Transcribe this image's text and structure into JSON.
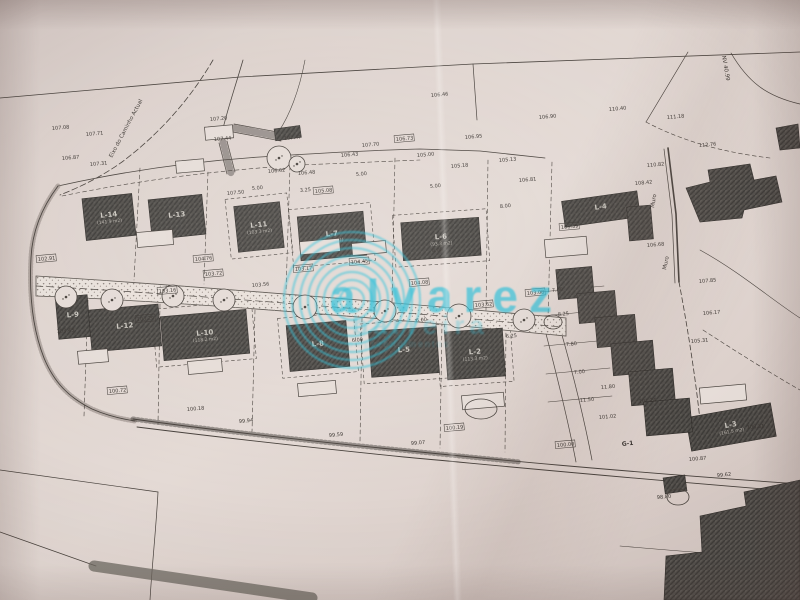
{
  "photo": {
    "paper_color": "#e0d5d0",
    "ink_color": "#46403b",
    "watermark_color": "#2bbdd6"
  },
  "watermark": {
    "line1": "alvarez",
    "line2": "barreira",
    "line3": "empreendimentos"
  },
  "plan": {
    "road_label": "Eixo do Caminho Actual",
    "nv_label": "NV 40.99",
    "muro1": "Muro",
    "muro2": "Muro",
    "g1_label": "G-1",
    "buildings": [
      {
        "label": "L-14",
        "area": "(141.9 m2)",
        "x": 84,
        "y": 196,
        "w": 50,
        "h": 42,
        "r": -6
      },
      {
        "label": "L-13",
        "area": "",
        "x": 150,
        "y": 197,
        "w": 54,
        "h": 40,
        "r": -6
      },
      {
        "label": "L-11",
        "area": "(103.3 m2)",
        "x": 236,
        "y": 204,
        "w": 46,
        "h": 46,
        "r": -6
      },
      {
        "label": "L-7",
        "area": "(93.9 m2)",
        "x": 299,
        "y": 214,
        "w": 66,
        "h": 44,
        "r": -5
      },
      {
        "label": "L-6",
        "area": "(93.3 m2)",
        "x": 402,
        "y": 220,
        "w": 78,
        "h": 38,
        "r": -4
      },
      {
        "label": "L-4",
        "area": "",
        "x": 563,
        "y": 196,
        "w": 76,
        "h": 26,
        "r": -8
      },
      {
        "label": "L-9",
        "area": "",
        "x": 57,
        "y": 296,
        "w": 32,
        "h": 42,
        "r": -5
      },
      {
        "label": "L-12",
        "area": "",
        "x": 90,
        "y": 307,
        "w": 70,
        "h": 42,
        "r": -5
      },
      {
        "label": "L-10",
        "area": "(118.2 m2)",
        "x": 162,
        "y": 313,
        "w": 86,
        "h": 44,
        "r": -5
      },
      {
        "label": "L-8",
        "area": "",
        "x": 288,
        "y": 323,
        "w": 60,
        "h": 46,
        "r": -5
      },
      {
        "label": "L-5",
        "area": "",
        "x": 370,
        "y": 329,
        "w": 68,
        "h": 46,
        "r": -4
      },
      {
        "label": "L-2",
        "area": "(113.3 m2)",
        "x": 446,
        "y": 330,
        "w": 58,
        "h": 48,
        "r": -4
      },
      {
        "label": "L-3",
        "area": "(161.5 m2)",
        "x": 688,
        "y": 410,
        "w": 86,
        "h": 34,
        "r": -10
      }
    ],
    "terrace": [
      [
        557,
        268,
        36,
        30
      ],
      [
        578,
        292,
        38,
        30
      ],
      [
        596,
        316,
        40,
        30
      ],
      [
        612,
        342,
        42,
        32
      ],
      [
        630,
        370,
        44,
        34
      ],
      [
        645,
        400,
        46,
        34
      ],
      [
        628,
        206,
        24,
        34
      ]
    ],
    "existing": [
      "686,188 710,182 708,170 750,164 754,180 776,176 782,202 744,210 742,218 700,222",
      "776,128 798,124 800,148 780,150",
      "700,516 746,506 744,492 800,480 800,600 664,600 666,556 702,552"
    ],
    "dark_rects": [
      [
        274,
        129,
        26,
        12
      ],
      [
        663,
        478,
        22,
        16
      ]
    ],
    "annexes": [
      [
        205,
        126,
        28,
        13
      ],
      [
        137,
        231,
        36,
        15
      ],
      [
        300,
        240,
        40,
        13
      ],
      [
        352,
        242,
        34,
        12
      ],
      [
        545,
        238,
        42,
        18
      ],
      [
        78,
        350,
        30,
        13
      ],
      [
        188,
        360,
        34,
        13
      ],
      [
        298,
        382,
        38,
        13
      ],
      [
        462,
        394,
        42,
        14
      ],
      [
        700,
        386,
        46,
        16
      ],
      [
        176,
        160,
        28,
        12
      ]
    ],
    "trees": [
      [
        66,
        297,
        11
      ],
      [
        112,
        300,
        11
      ],
      [
        173,
        296,
        11
      ],
      [
        224,
        300,
        11
      ],
      [
        305,
        307,
        12
      ],
      [
        385,
        311,
        11
      ],
      [
        459,
        316,
        12
      ],
      [
        524,
        320,
        11
      ],
      [
        279,
        158,
        12
      ],
      [
        297,
        164,
        8
      ]
    ],
    "ellipses": [
      [
        481,
        409,
        16,
        10
      ],
      [
        678,
        497,
        11,
        8
      ],
      [
        553,
        322,
        9,
        7
      ]
    ],
    "elevations": [
      [
        "107.08",
        52,
        130,
        0
      ],
      [
        "107.71",
        86,
        136,
        0
      ],
      [
        "106.87",
        62,
        160,
        0
      ],
      [
        "107.31",
        90,
        166,
        0
      ],
      [
        "107.20",
        210,
        121,
        0
      ],
      [
        "107.44",
        214,
        141,
        0
      ],
      [
        "107.47",
        284,
        140,
        0
      ],
      [
        "106.62",
        268,
        173,
        0
      ],
      [
        "106.48",
        298,
        175,
        0
      ],
      [
        "106.43",
        341,
        157,
        0
      ],
      [
        "107.70",
        362,
        147,
        0
      ],
      [
        "106.73",
        396,
        141,
        1
      ],
      [
        "106.46",
        431,
        97,
        0
      ],
      [
        "105.00",
        417,
        157,
        0
      ],
      [
        "106.95",
        465,
        139,
        0
      ],
      [
        "105.18",
        451,
        168,
        0
      ],
      [
        "105.13",
        499,
        162,
        0
      ],
      [
        "106.90",
        539,
        119,
        0
      ],
      [
        "106.81",
        519,
        182,
        0
      ],
      [
        "110.40",
        609,
        111,
        0
      ],
      [
        "111.18",
        667,
        119,
        0
      ],
      [
        "112.76",
        699,
        147,
        0
      ],
      [
        "110.82",
        647,
        167,
        0
      ],
      [
        "108.42",
        635,
        185,
        0
      ],
      [
        "107.85",
        699,
        283,
        0
      ],
      [
        "106.68",
        647,
        247,
        0
      ],
      [
        "106.17",
        703,
        315,
        0
      ],
      [
        "105.31",
        691,
        343,
        0
      ],
      [
        "106.39",
        561,
        229,
        1
      ],
      [
        "107.50",
        227,
        195,
        0
      ],
      [
        "105.08",
        315,
        193,
        1
      ],
      [
        "104.45",
        351,
        264,
        1
      ],
      [
        "104.76",
        195,
        261,
        1
      ],
      [
        "103.72",
        205,
        276,
        1
      ],
      [
        "103.16",
        159,
        293,
        1
      ],
      [
        "103.29",
        137,
        321,
        1
      ],
      [
        "103.17",
        295,
        271,
        1
      ],
      [
        "103.56",
        252,
        287,
        0
      ],
      [
        "104.08",
        411,
        285,
        1
      ],
      [
        "103.62",
        475,
        307,
        1
      ],
      [
        "103.08",
        527,
        295,
        1
      ],
      [
        "102.91",
        38,
        261,
        1
      ],
      [
        "103.43",
        57,
        333,
        0
      ],
      [
        "100.72",
        109,
        393,
        1
      ],
      [
        "100.18",
        187,
        411,
        0
      ],
      [
        "99.94",
        239,
        423,
        0
      ],
      [
        "99.59",
        329,
        437,
        0
      ],
      [
        "99.07",
        411,
        445,
        0
      ],
      [
        "100.19",
        446,
        430,
        1
      ],
      [
        "100.00",
        557,
        447,
        1
      ],
      [
        "101.02",
        599,
        419,
        0
      ],
      [
        "101.24",
        639,
        403,
        0
      ],
      [
        "100.87",
        689,
        461,
        0
      ],
      [
        "99.62",
        717,
        477,
        0
      ],
      [
        "98.80",
        657,
        499,
        0
      ],
      [
        "100.31",
        747,
        429,
        0
      ]
    ],
    "dims": [
      [
        "5.00",
        252,
        190
      ],
      [
        "3.25",
        300,
        192
      ],
      [
        "5.00",
        356,
        176
      ],
      [
        "5.00",
        430,
        188
      ],
      [
        "8.00",
        500,
        208
      ],
      [
        "8.00",
        432,
        252
      ],
      [
        "6.00",
        352,
        342
      ],
      [
        "5.00",
        318,
        352
      ],
      [
        "6.25",
        506,
        338
      ],
      [
        "6.00",
        416,
        322
      ],
      [
        "7.00",
        552,
        292
      ],
      [
        "8.25",
        558,
        316
      ],
      [
        "7.80",
        566,
        346
      ],
      [
        "7.00",
        574,
        374
      ],
      [
        "11.50",
        580,
        402
      ],
      [
        "11.80",
        601,
        389
      ]
    ]
  }
}
